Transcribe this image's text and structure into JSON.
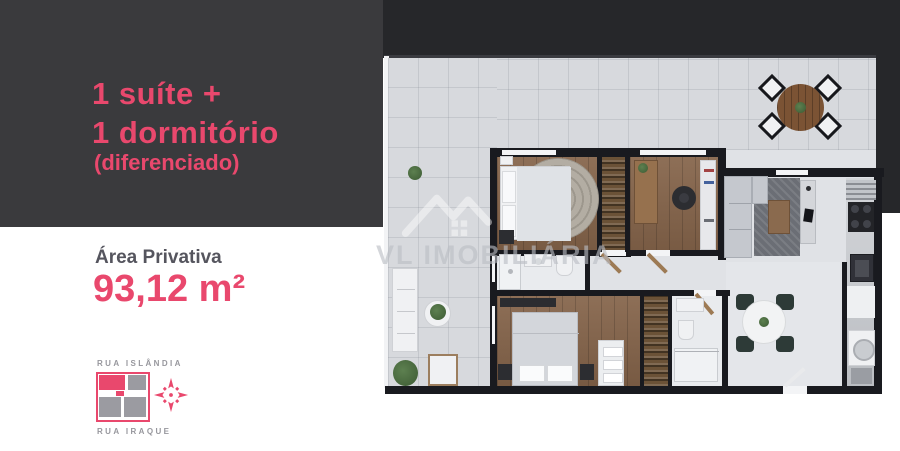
{
  "flyer": {
    "headline": {
      "line1": "1 suíte +",
      "line2": "1 dormitório",
      "note": "(diferenciado)"
    },
    "area": {
      "label": "Área Privativa",
      "value": "93,12 m²"
    },
    "location": {
      "street_top": "RUA ISLÂNDIA",
      "street_bottom": "RUA IRAQUE",
      "compass_icon": "compass-rose",
      "lot_icon": "lot-quadrants-map"
    },
    "watermark": {
      "text": "VL IMOBILIÁRIA",
      "icon": "house-check-logo"
    },
    "colors": {
      "accent": "#e9486d",
      "panel_dark": "#3a3a3d",
      "plan_background": "#26272a",
      "terrace_tile": "#d7d9dd",
      "wood_floor": "#85644a",
      "wall": "#191a1f"
    }
  }
}
